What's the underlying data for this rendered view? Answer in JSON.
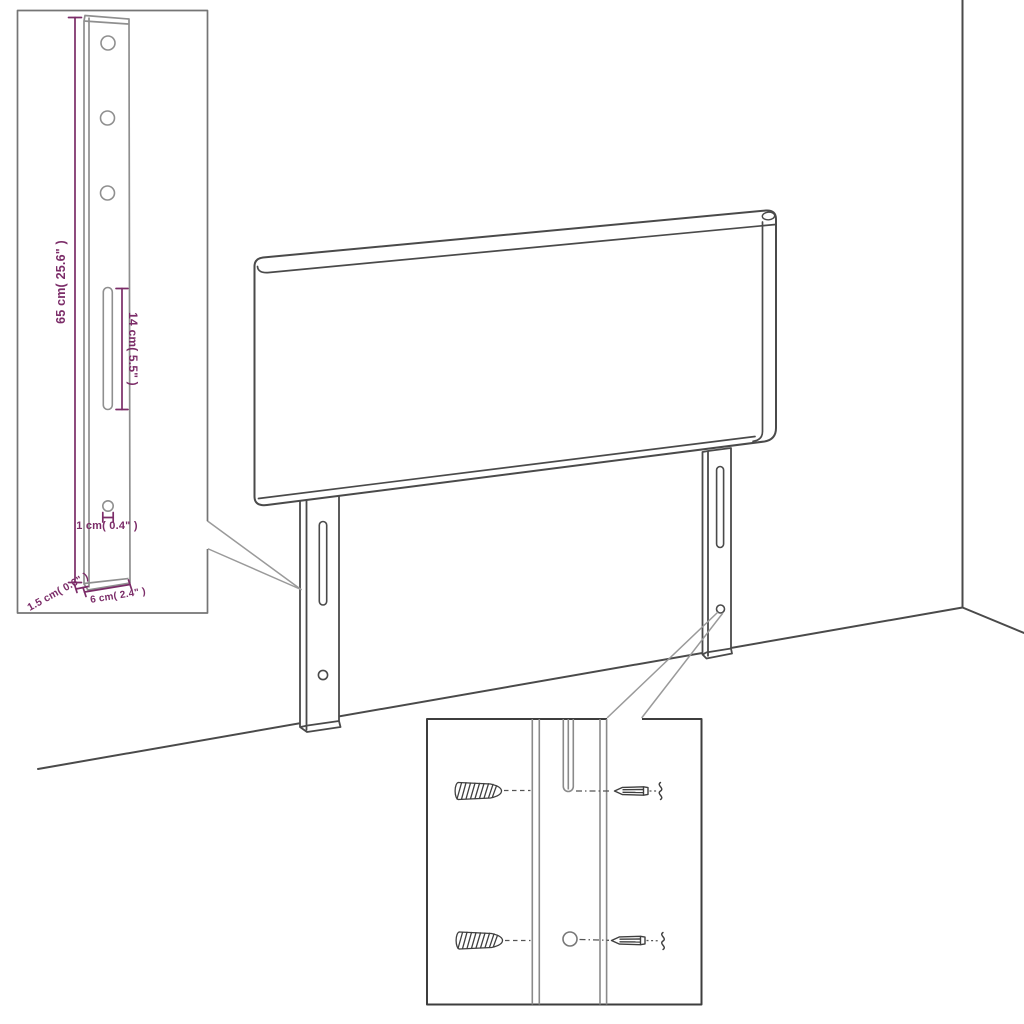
{
  "diagram": {
    "type": "product-dimension-diagram",
    "subject": "headboard with two slotted mounting legs shown against a wall corner",
    "colors": {
      "background": "#ffffff",
      "outline": "#4a4a4a",
      "inset_line": "#8f8f8f",
      "dimension": "#7b2c68",
      "callout": "#9a9a9a"
    },
    "dimensions": {
      "leg_height": "65 cm( 25.6\" )",
      "slot_length": "14 cm( 5.5\" )",
      "hole_diameter": "1 cm( 0.4\" )",
      "leg_thickness": "1.5 cm( 0.6\" )",
      "leg_width": "6 cm( 2.4\" )"
    },
    "insets": {
      "leg_detail": {
        "position": "top-left"
      },
      "mounting_detail": {
        "position": "bottom-right",
        "parts": [
          "wall-plug",
          "wall-plug",
          "screw",
          "screw"
        ]
      }
    }
  }
}
